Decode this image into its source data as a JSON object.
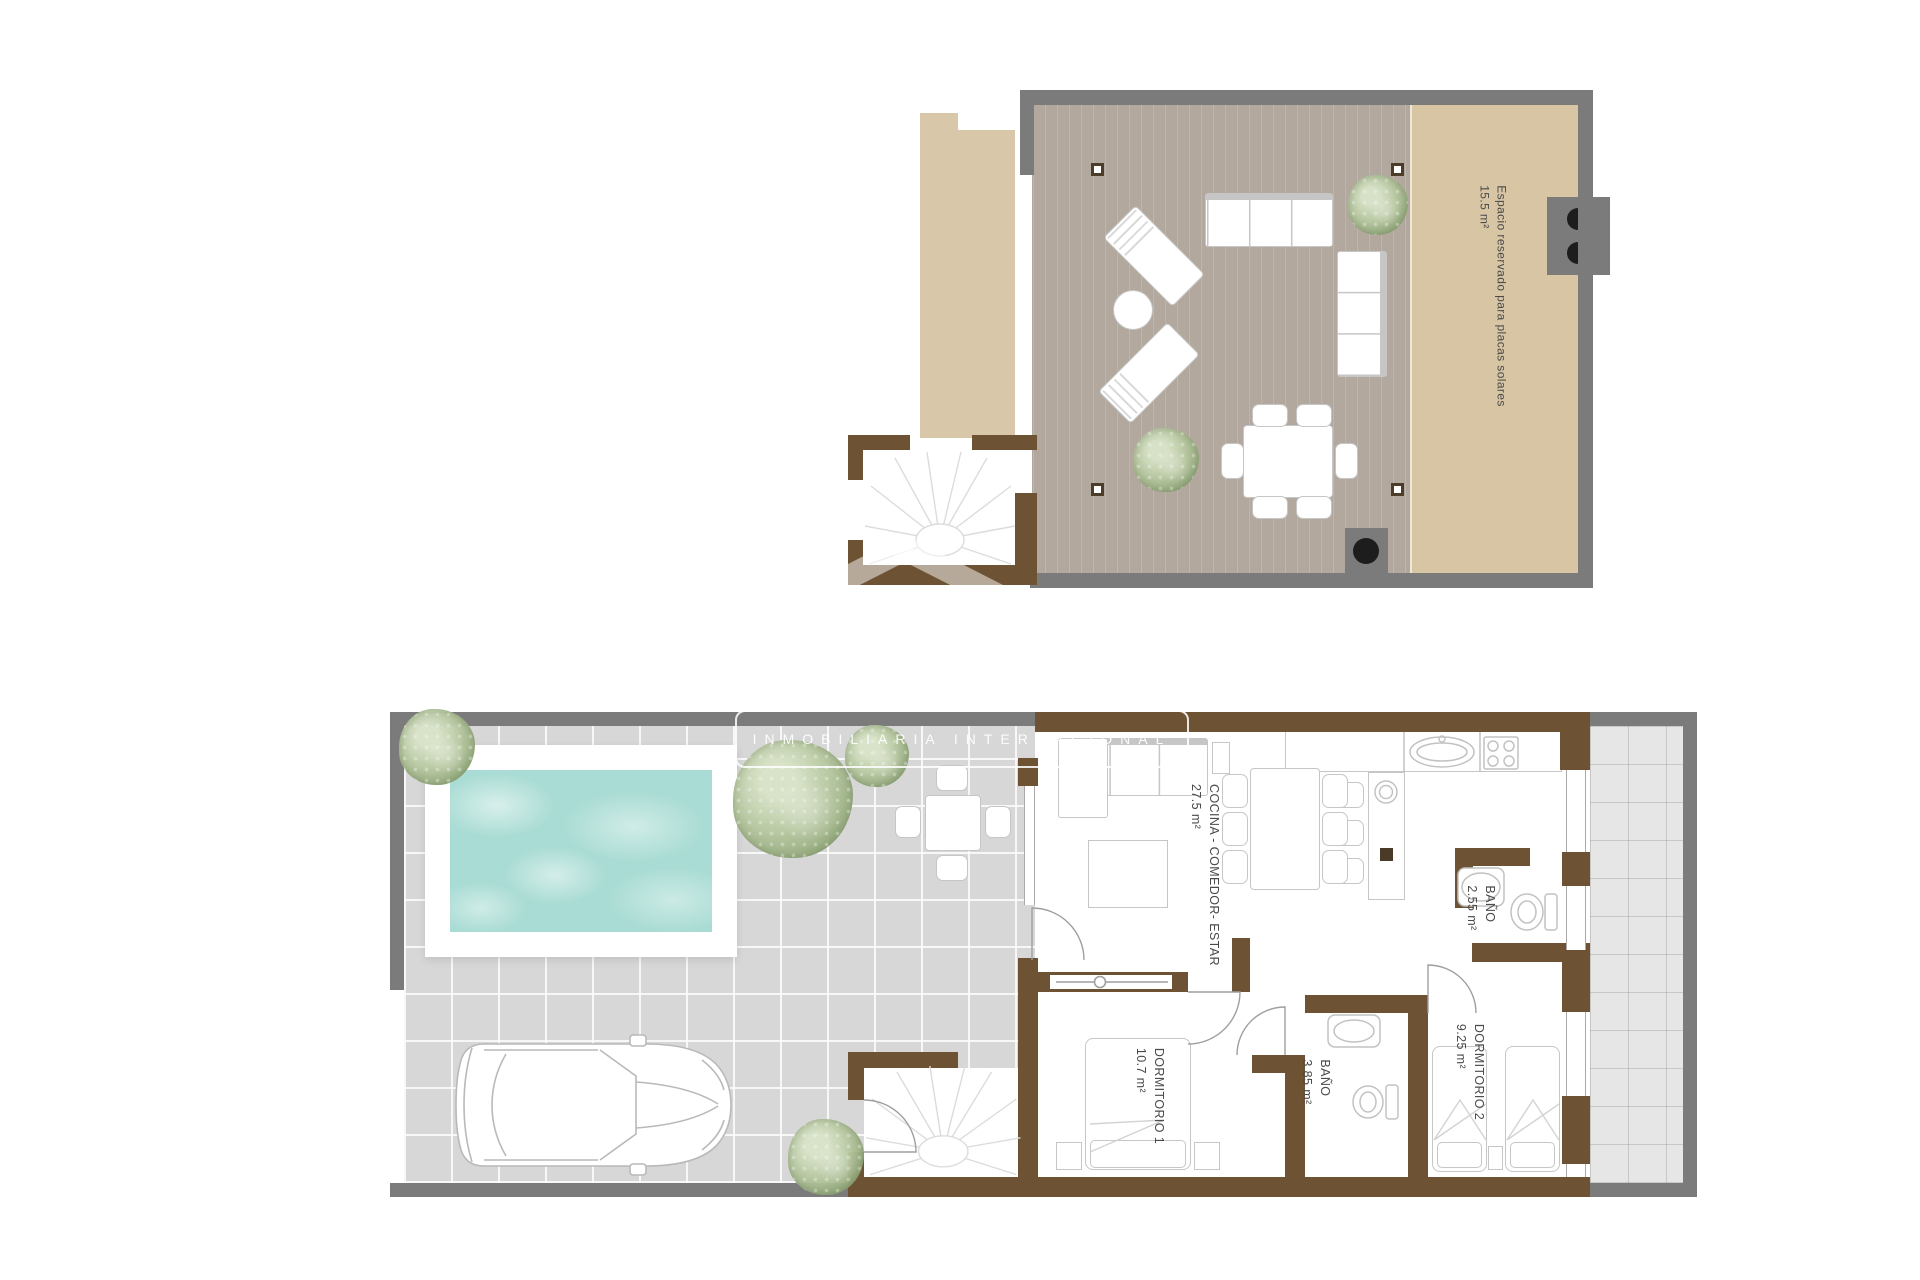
{
  "watermark": {
    "brand": "INMOBILIARIA INTERNACIONAL"
  },
  "roof": {
    "solar_label": {
      "line1": "Espacio reservado para placas solares",
      "line2": "15.5 m²"
    }
  },
  "ground": {
    "rooms": [
      {
        "key": "cocina-comedor-estar",
        "line1": "COCINA - COMEDOR- ESTAR",
        "line2": "27.5 m²"
      },
      {
        "key": "bano-1",
        "line1": "BAÑO",
        "line2": "2.55 m²"
      },
      {
        "key": "dormitorio-1",
        "line1": "DORMITORIO 1",
        "line2": "10.7 m²"
      },
      {
        "key": "bano-2",
        "line1": "BAÑO",
        "line2": "3.85 m²"
      },
      {
        "key": "dormitorio-2",
        "line1": "DORMITORIO 2",
        "line2": "9.25 m²"
      }
    ]
  },
  "colors": {
    "wall-gray": "#7b7b7b",
    "wall-brown": "#6d5233",
    "tan": "#d8c5a4",
    "tan-strip": "#d9c7a9",
    "deck-base": "#b3a89d",
    "tile": "#d7d7d7",
    "tile-light": "#e6e6e6",
    "pool": "#a9dcd4",
    "line": "#c6c6c6",
    "label": "#4a4a4a",
    "black": "#1d1d1d"
  }
}
